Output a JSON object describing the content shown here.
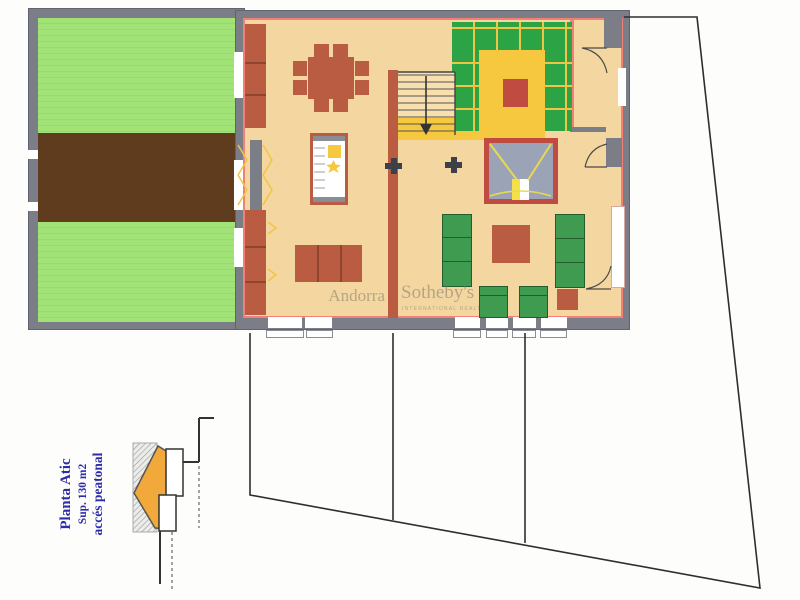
{
  "plan_label": {
    "line1": "Planta Atic",
    "line2": "Sup. 130 m2",
    "line3": "accés peatonal"
  },
  "watermark": {
    "brand_left": "Andorra",
    "brand_right": "Sotheby's",
    "brand_sub": "INTERNATIONAL REALTY"
  },
  "colors": {
    "wall": "#7b7e86",
    "terrace_green": "#a2e377",
    "deck_brown": "#5f3c1e",
    "floor_tan": "#f4d7a0",
    "accent_pink": "#f28077",
    "furn_red": "#b95c41",
    "kitchen_green": "#2ca446",
    "grid_yellow": "#f0c445",
    "yellow": "#f6c840",
    "fire_gray": "#9ba3b7",
    "fire_border": "#c04b41",
    "sofa_green": "#3f9b4f",
    "column_dark": "#3c4049",
    "boundary": "#2e2e2e",
    "label_blue": "#2d2dac"
  }
}
